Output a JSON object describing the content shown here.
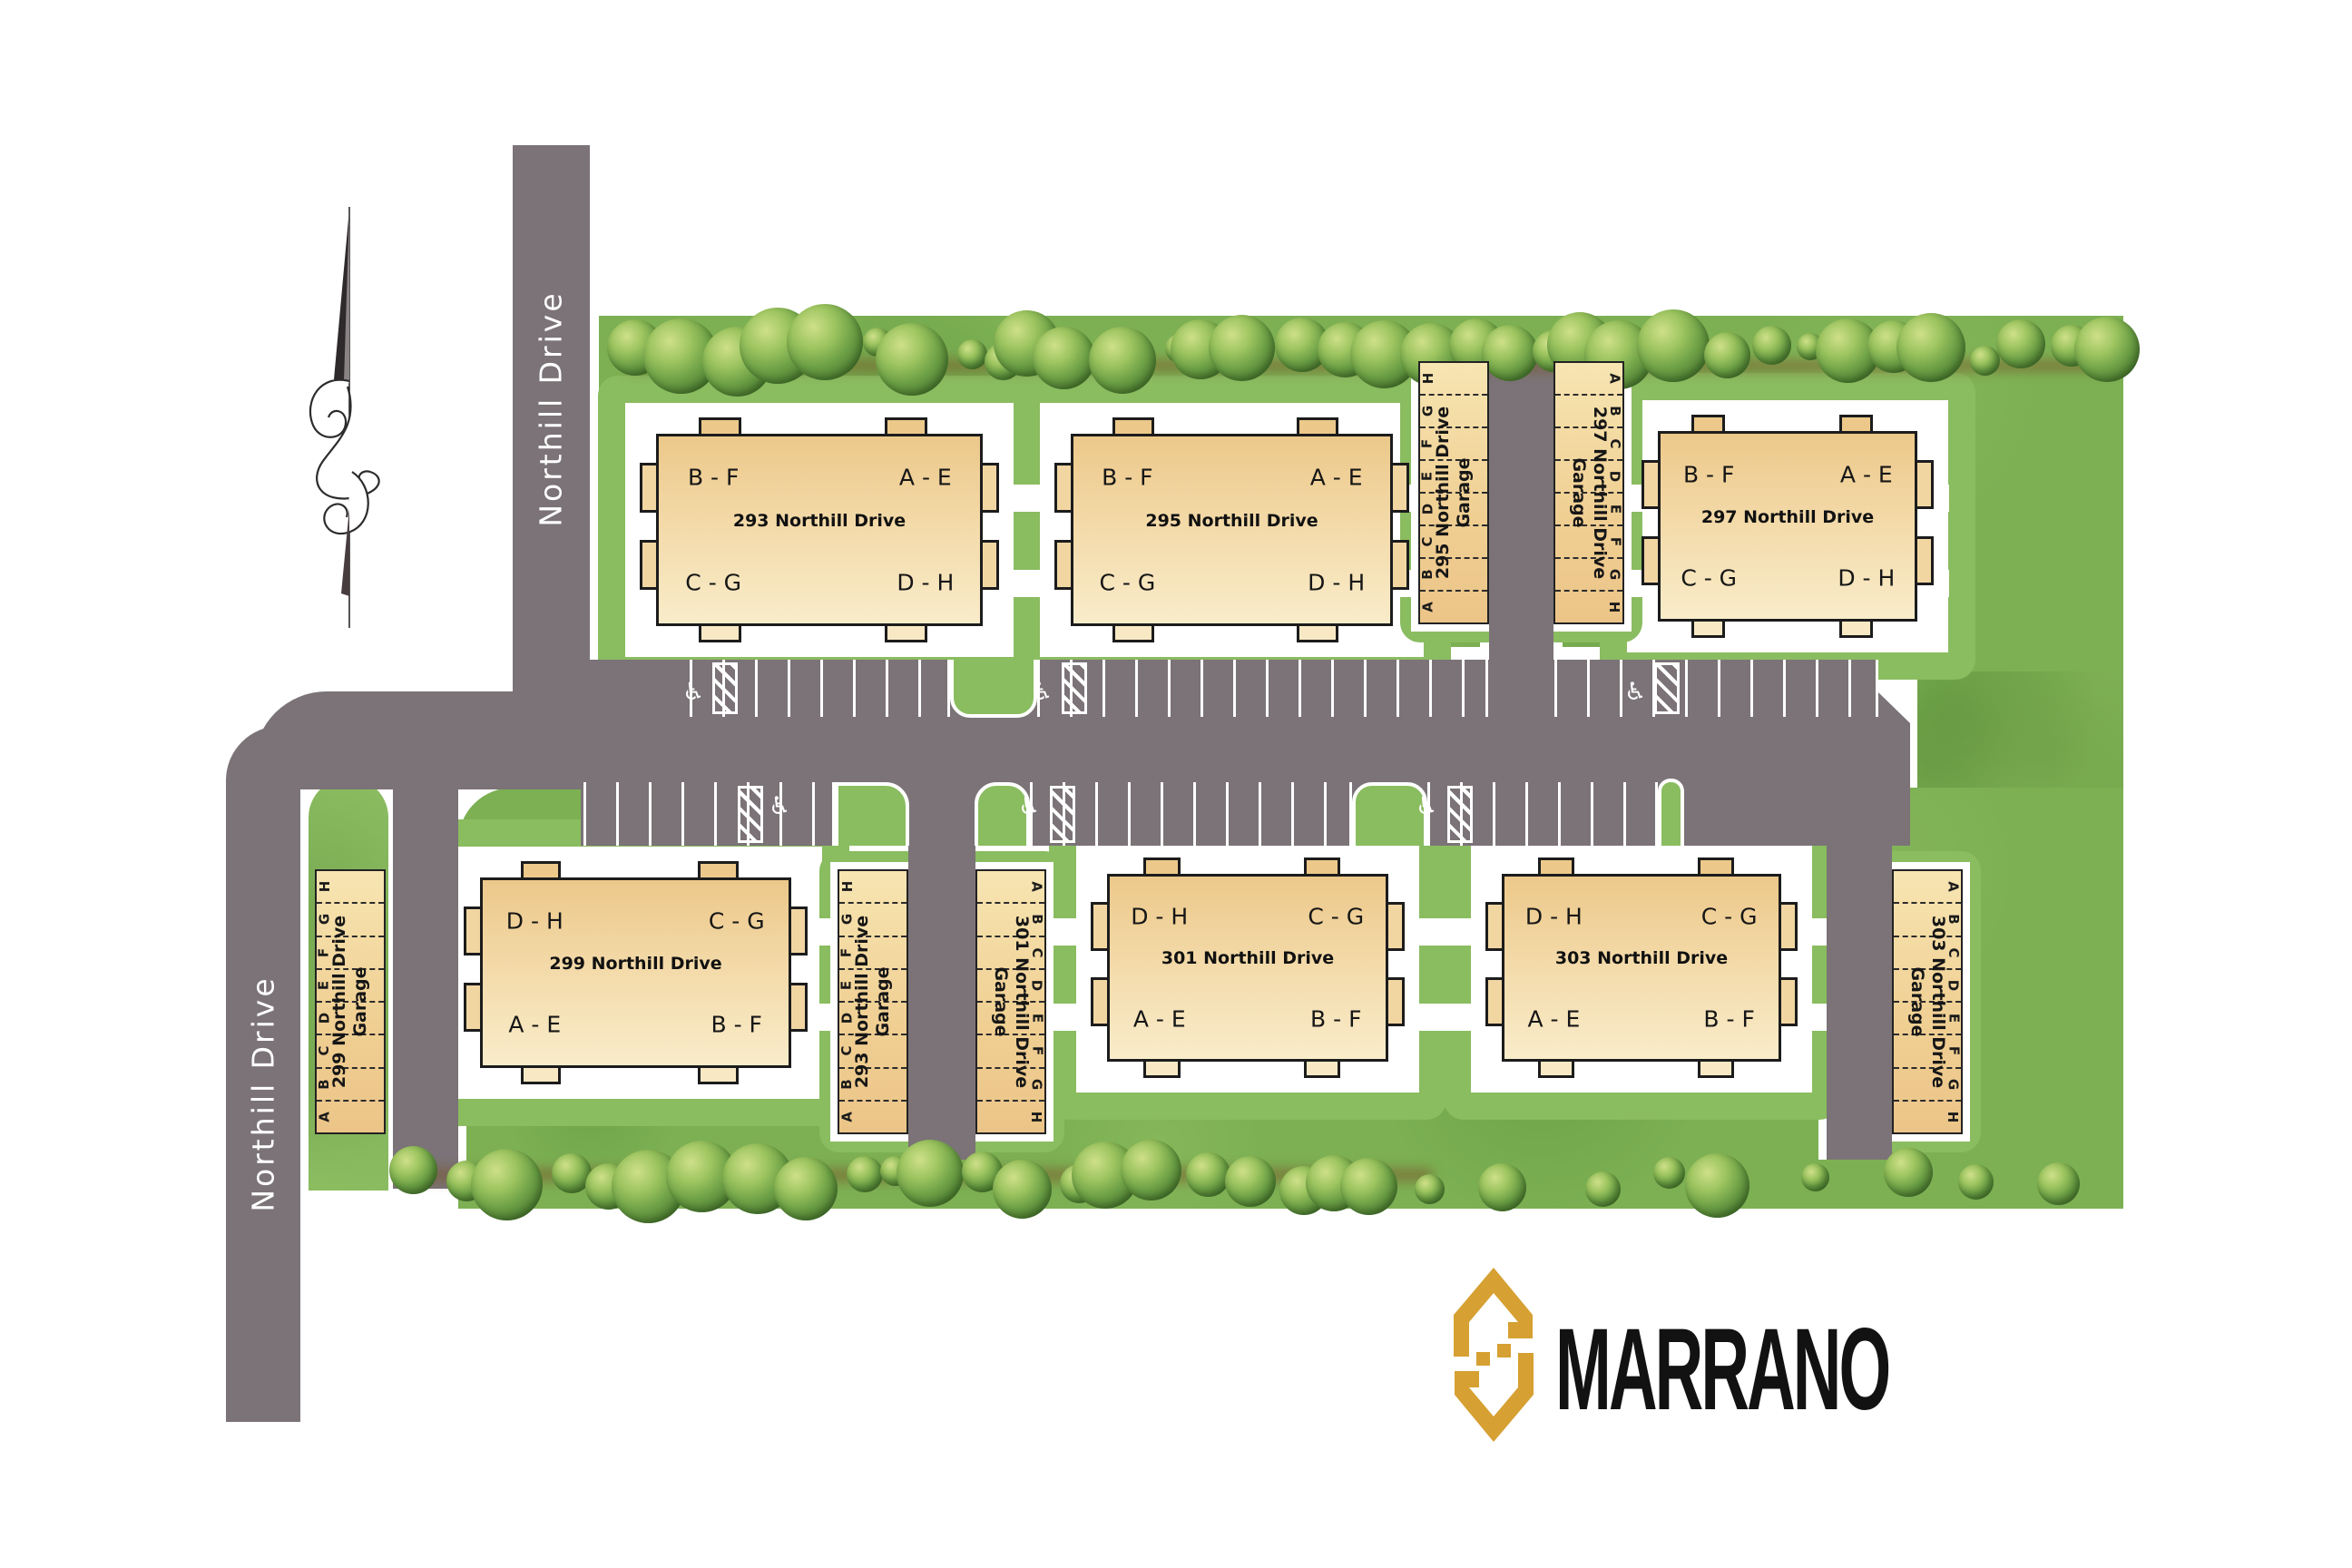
{
  "site": {
    "road_labels": [
      "Northill Drive",
      "Northill Drive"
    ],
    "accessible_symbol": "♿",
    "buildings": [
      {
        "name": "293 Northill Drive",
        "units": {
          "tl": "B - F",
          "tr": "A - E",
          "bl": "C - G",
          "br": "D - H"
        }
      },
      {
        "name": "295 Northill Drive",
        "units": {
          "tl": "B - F",
          "tr": "A - E",
          "bl": "C - G",
          "br": "D - H"
        }
      },
      {
        "name": "297 Northill Drive",
        "units": {
          "tl": "B - F",
          "tr": "A - E",
          "bl": "C - G",
          "br": "D - H"
        }
      },
      {
        "name": "299 Northill Drive",
        "units": {
          "tl": "D - H",
          "tr": "C - G",
          "bl": "A - E",
          "br": "B - F"
        }
      },
      {
        "name": "301 Northill Drive",
        "units": {
          "tl": "D - H",
          "tr": "C - G",
          "bl": "A - E",
          "br": "B - F"
        }
      },
      {
        "name": "303 Northill Drive",
        "units": {
          "tl": "D - H",
          "tr": "C - G",
          "bl": "A - E",
          "br": "B - F"
        }
      }
    ],
    "garages": [
      {
        "label_line1": "295 Northill Drive",
        "label_line2": "Garage",
        "stalls": [
          "A",
          "B",
          "C",
          "D",
          "E",
          "F",
          "G",
          "H"
        ],
        "letters_side": "left"
      },
      {
        "label_line1": "297 Northill Drive",
        "label_line2": "Garage",
        "stalls": [
          "A",
          "B",
          "C",
          "D",
          "E",
          "F",
          "G",
          "H"
        ],
        "letters_side": "right"
      },
      {
        "label_line1": "299 Northill Drive",
        "label_line2": "Garage",
        "stalls": [
          "A",
          "B",
          "C",
          "D",
          "E",
          "F",
          "G",
          "H"
        ],
        "letters_side": "left"
      },
      {
        "label_line1": "293 Northill Drive",
        "label_line2": "Garage",
        "stalls": [
          "A",
          "B",
          "C",
          "D",
          "E",
          "F",
          "G",
          "H"
        ],
        "letters_side": "left"
      },
      {
        "label_line1": "301 Northill Drive",
        "label_line2": "Garage",
        "stalls": [
          "A",
          "B",
          "C",
          "D",
          "E",
          "F",
          "G",
          "H"
        ],
        "letters_side": "right"
      },
      {
        "label_line1": "303 Northill Drive",
        "label_line2": "Garage",
        "stalls": [
          "A",
          "B",
          "C",
          "D",
          "E",
          "F",
          "G",
          "H"
        ],
        "letters_side": "right"
      }
    ]
  },
  "logo": {
    "text": "MARRANO"
  },
  "colors": {
    "road_gray": "#7b7377",
    "grass_green": "#7cb053",
    "grass_light": "#8abc60",
    "building_tan": "#eeca8c",
    "building_outline": "#1c1c1c",
    "logo_gold": "#d6a032",
    "stripe_white": "#ffffff"
  }
}
